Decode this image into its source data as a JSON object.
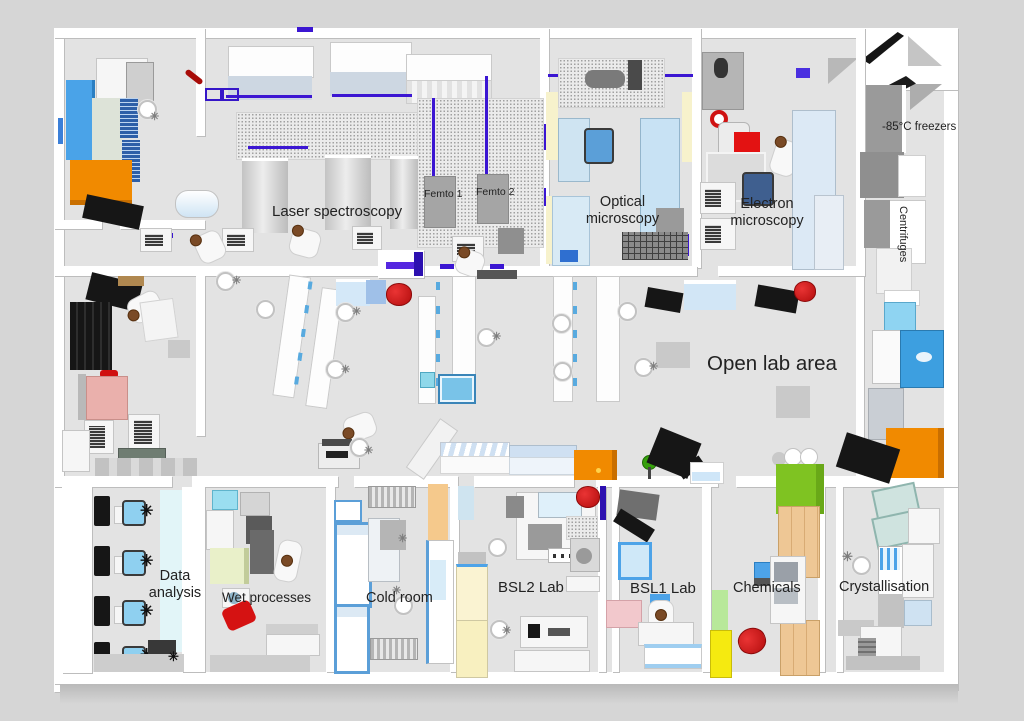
{
  "labels": {
    "laser_spectroscopy": "Laser spectroscopy",
    "femto1": "Femto 1",
    "femto2": "Femto 2",
    "optical_microscopy": "Optical microscopy",
    "electron_microscopy": "Electron microscopy",
    "freezers": "-85°C freezers",
    "centrifuges": "Centrifuges",
    "open_lab": "Open lab area",
    "data_analysis": "Data analysis",
    "wet_processes": "Wet processes",
    "cold_room": "Cold room",
    "bsl2": "BSL2 Lab",
    "bsl1": "BSL1 Lab",
    "chemicals": "Chemicals",
    "crystallisation": "Crystallisation"
  },
  "palette": {
    "background": "#D6D6D6",
    "floor": "#E3E3E3",
    "wall": "#FFFFFF",
    "accent_orange": "#F18A00",
    "accent_blue": "#4DA3E8",
    "laser_purple": "#3B16D2",
    "alert_red": "#CF1212",
    "lime_green": "#7FC322",
    "pale_yellow": "#F5EA3C",
    "cream": "#FAF3D2",
    "tan": "#EEC795",
    "pink": "#EAB0AC"
  }
}
